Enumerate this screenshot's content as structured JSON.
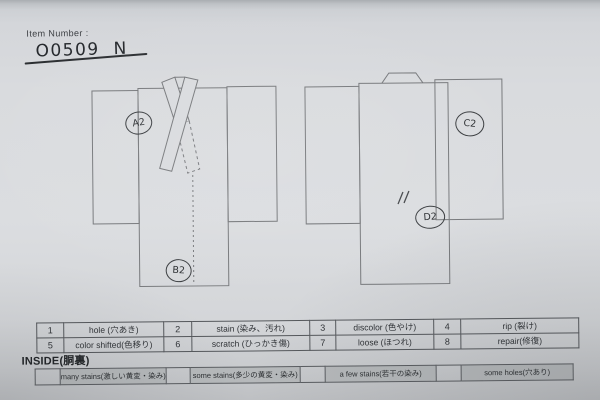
{
  "header": {
    "label": "Item Number :",
    "value": "O0509 N"
  },
  "diagram": {
    "front": {
      "view": "kimono front with crossed collar",
      "annotations": [
        {
          "label": "A2",
          "location": "left shoulder seam"
        },
        {
          "label": "B2",
          "location": "bottom hem center"
        }
      ]
    },
    "back": {
      "view": "kimono back with neckband",
      "annotations": [
        {
          "label": "C2",
          "location": "right sleeve"
        },
        {
          "label": "D2",
          "location": "lower right of body"
        }
      ],
      "marks": [
        {
          "name": "double-slash-mark",
          "symbol": "〃"
        }
      ]
    }
  },
  "condition_table": {
    "rows": [
      [
        {
          "num": "1",
          "label": "hole (穴あき)"
        },
        {
          "num": "2",
          "label": "stain (染み、汚れ)"
        },
        {
          "num": "3",
          "label": "discolor (色やけ)"
        },
        {
          "num": "4",
          "label": "rip (裂け)"
        }
      ],
      [
        {
          "num": "5",
          "label": "color shifted(色移り)"
        },
        {
          "num": "6",
          "label": "scratch (ひっかき傷)"
        },
        {
          "num": "7",
          "label": "loose (ほつれ)"
        },
        {
          "num": "8",
          "label": "repair(修復)"
        }
      ]
    ]
  },
  "inside": {
    "title": "INSIDE(胴裏)",
    "options": [
      "many stains(激しい黄変・染み)",
      "some stains(多少の黄変・染み)",
      "a few stains(若干の染み)",
      "some holes(穴あり)"
    ]
  },
  "colors": {
    "paper": "#d9dbde",
    "template_line": "#77797c",
    "table_border": "#55585c",
    "grey_cell": "#b6b9bb",
    "ink": "#2f3236",
    "handwriting": "#2b2e31"
  }
}
